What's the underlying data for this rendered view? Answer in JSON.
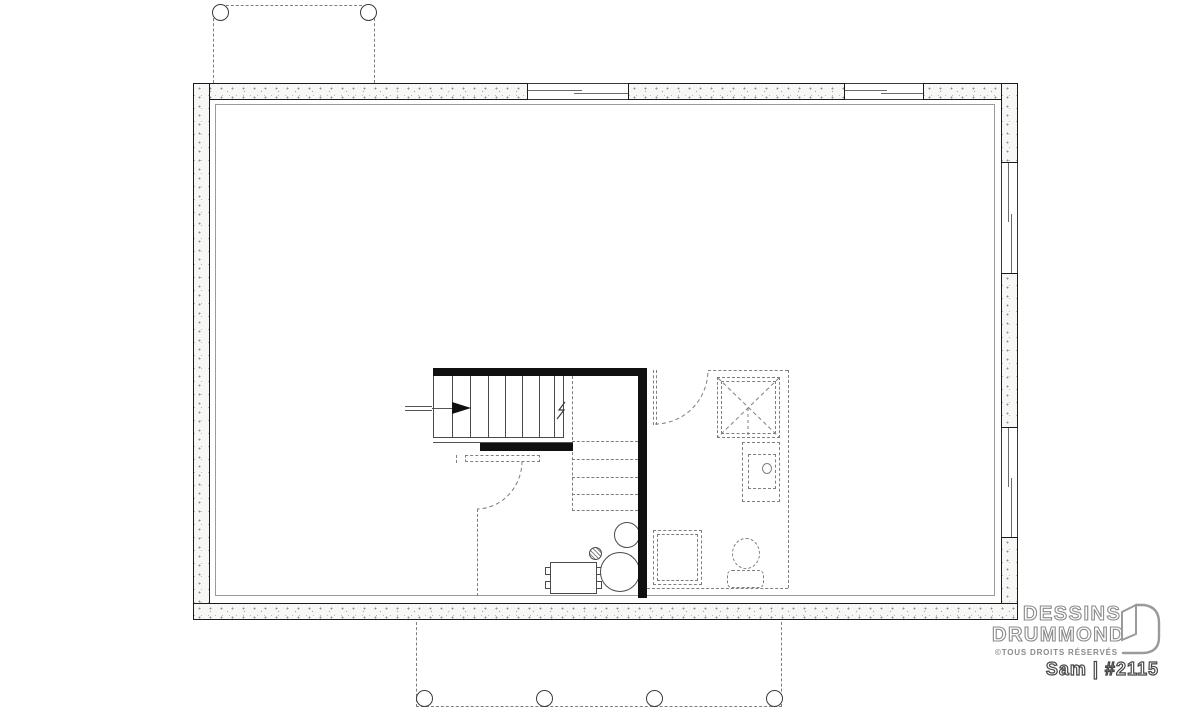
{
  "branding": {
    "line1": "DESSINS",
    "line2": "DRUMMOND",
    "rights": "©TOUS DROITS RÉSERVÉS",
    "plan_ref": "Sam | #2115"
  },
  "icons": {
    "stair_direction_arrow": "right-filled-arrow",
    "stair_break_line": "zigzag",
    "logo_mark": "open-door-d"
  },
  "colors": {
    "line": "#3a3a3a",
    "dashed_line": "#7f7f7f",
    "structural_wall": "#101010",
    "wall_fill": "#f7f7f5",
    "logo_gray": "#8a8a8a"
  }
}
